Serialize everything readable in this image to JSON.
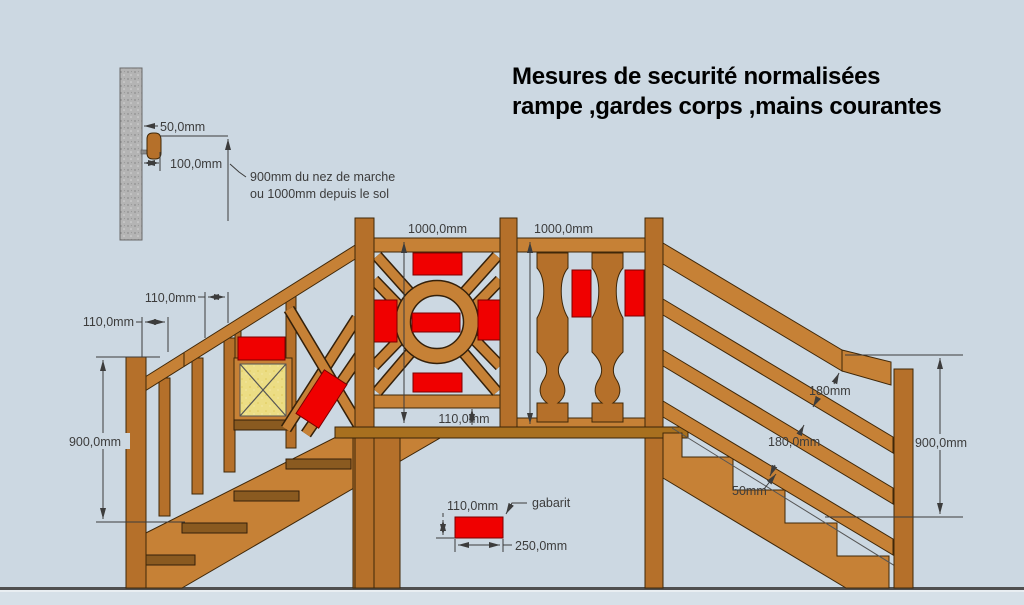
{
  "title": {
    "line1": "Mesures de securité normalisées",
    "line2": "rampe ,gardes corps ,mains courantes"
  },
  "wall_detail": {
    "dim_wall_offset": "50,0mm",
    "dim_clearance": "100,0mm",
    "note_line1": "900mm du nez de marche",
    "note_line2": "ou 1000mm depuis le sol"
  },
  "left_stair": {
    "dim_gap_upper": "110,0mm",
    "dim_gap_lower": "110,0mm",
    "dim_handrail_height": "900,0mm"
  },
  "landing_guard": {
    "dim_panel1_height": "1000,0mm",
    "dim_panel2_height": "1000,0mm",
    "dim_bottom_gap": "110,0mm"
  },
  "gabarit_legend": {
    "label": "gabarit",
    "dim_height": "110,0mm",
    "dim_width": "250,0mm"
  },
  "right_stair": {
    "dim_gap_handrail": "180mm",
    "dim_gap_rails": "180,0mm",
    "dim_gap_nosing": "50mm",
    "dim_handrail_height": "900,0mm"
  },
  "colors": {
    "background": "#ccd8e2",
    "below_ground": "#d6e0e8",
    "wood_light": "#c68136",
    "wood_mid": "#b5702a",
    "wood_dark": "#8a5a20",
    "outline": "#3f2708",
    "gabarit_red": "#f00000",
    "infill_yellow": "#ecdd84",
    "wall_gray": "#b4b4b4",
    "dim_text": "#3c3c3c"
  }
}
